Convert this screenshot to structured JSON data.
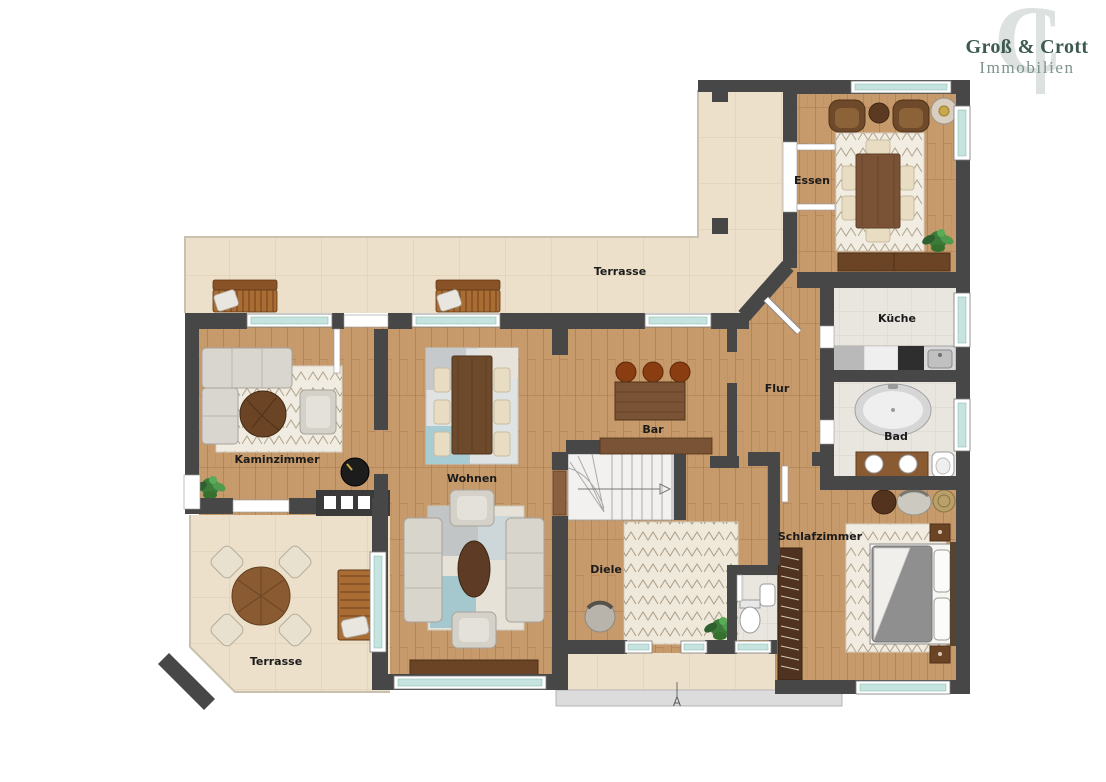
{
  "logo": {
    "line1": "Groß & Crott",
    "line2": "Immobilien",
    "monogram": "C",
    "primary_color": "#3d5a50",
    "secondary_color": "#7d938b",
    "monogram_color": "#dde2e0"
  },
  "floorplan": {
    "rooms": {
      "essen": {
        "label": "Essen"
      },
      "terrasse_oben": {
        "label": "Terrasse"
      },
      "kueche": {
        "label": "Küche"
      },
      "flur": {
        "label": "Flur"
      },
      "bad": {
        "label": "Bad"
      },
      "bar": {
        "label": "Bar"
      },
      "kaminzimmer": {
        "label": "Kaminzimmer"
      },
      "wohnen": {
        "label": "Wohnen"
      },
      "diele": {
        "label": "Diele"
      },
      "schlafzimmer": {
        "label": "Schlafzimmer"
      },
      "terrasse_unten": {
        "label": "Terrasse"
      }
    },
    "entrance_marker": {
      "label": "A"
    },
    "colors": {
      "wall": "#474747",
      "wood_floor": "#c69a6b",
      "terrace_tile": "#ece0ca",
      "bath_tile": "#e9e5df",
      "window_glass": "#c5e4df",
      "label_text": "#1b1b1b",
      "furniture_wood": "#7a5236",
      "upholstery": "#d9d6cf"
    }
  }
}
